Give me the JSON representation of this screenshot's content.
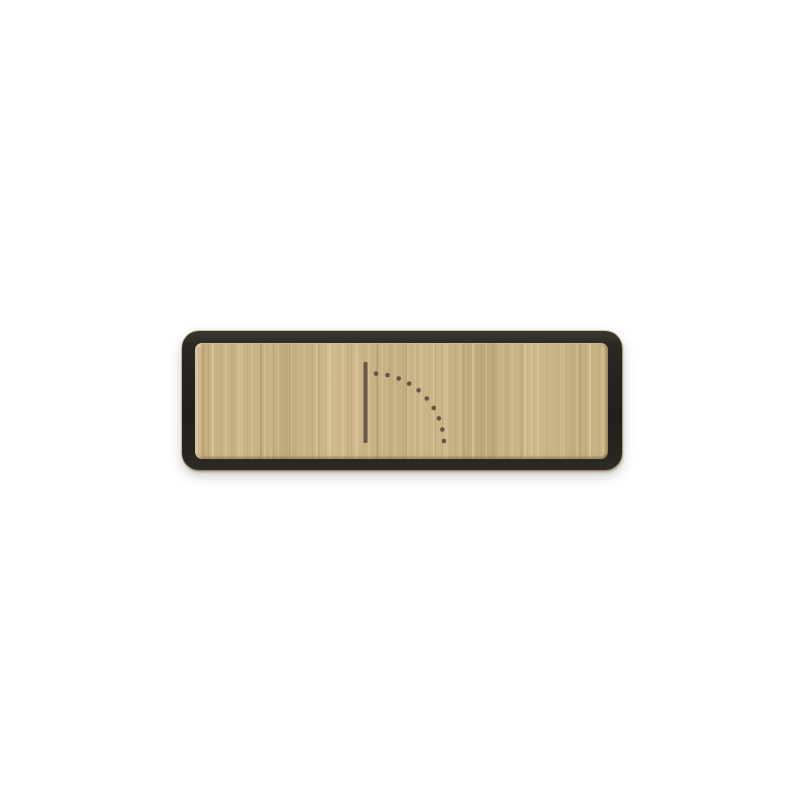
{
  "canvas": {
    "width": 807,
    "height": 807,
    "background": "#ffffff"
  },
  "sign": {
    "kind": "wooden-door-sign-plate",
    "geometry": {
      "left": 182,
      "top": 331,
      "width": 440,
      "height": 139,
      "corner_radius": 17,
      "frame_thickness": 13
    },
    "colors": {
      "frame": "#262320",
      "frame_top_highlight": "#3b3831",
      "frame_rim": "#9e803e",
      "wood_base": "#c6b083",
      "wood_light": "#d8c498",
      "wood_dark": "#ab9468",
      "icon": "#56493a"
    },
    "icon": {
      "name": "door-swing-icon",
      "color": "#56493a",
      "door_line": {
        "x": 183.5,
        "y_top": 31,
        "y_bottom": 112,
        "width": 4
      },
      "swing_dots": {
        "center_x": 190.5,
        "center_y": 114,
        "radius": 71.5,
        "start_angle_deg": 87.2,
        "end_angle_deg": 3.2,
        "count": 10,
        "dot_radius": 2.1
      }
    }
  }
}
